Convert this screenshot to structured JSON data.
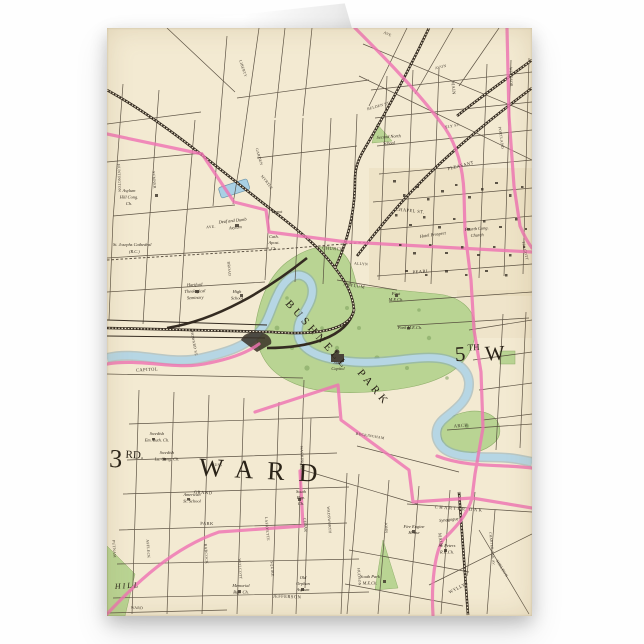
{
  "scene": {
    "background": "#fefefe",
    "paper_color": "#f3ead2",
    "pink_boundary": "#ef74b3",
    "park_green": "#b9d493",
    "river_blue": "#b6d6e4",
    "rail_color": "#342b21",
    "street_color": "#4d4335"
  },
  "map": {
    "big_labels": {
      "ward3_num": "3",
      "ward3_sup": "RD.",
      "ward3_word": "WARD",
      "ward5_num": "5",
      "ward5_sup": "TH",
      "ward5_word": "W",
      "bushnell": "BUSHNELL",
      "bushnell_park": "PARK",
      "hill": "HILL"
    },
    "streets": {
      "pearl": "PEARL",
      "main_top": "MAIN",
      "main_lower": "MAIN",
      "asylum": "ASYLUM",
      "church": "CHURCH",
      "allyn": "ALLYN",
      "chapel": "CHAPEL ST.",
      "pleasant": "PLEASANT",
      "charter_oak": "CHARTER OAK",
      "jefferson": "JEFFERSON",
      "capitol_st": "CAPITOL",
      "howard": "HOWARD ST.",
      "park_st": "PARK",
      "grand": "GRAND",
      "lafayette": "LAFAYETTE",
      "wadsworth": "WADSWORTH",
      "cedar": "CEDAR",
      "hudson": "HUDSON",
      "wyllys": "WYLLYS",
      "arch": "ARCH",
      "belden": "BELDEN ST.",
      "avon": "AVON",
      "portland": "PORTLAND",
      "windsor": "WINDSOR",
      "talcott": "TALCOTT",
      "sumner": "SUMNER",
      "huntington": "HUNTINGTON",
      "broad": "BROAD",
      "washington": "WASHINGTON",
      "liberty": "LIBERTY",
      "ely": "ELY ST.",
      "myrtle": "MYRTLE",
      "garden": "GARDEN",
      "ave_asylum": "AVE.",
      "ave_albany": "AVE",
      "buckingham": "BUCKINGHAM",
      "russ": "RUSS",
      "ward_st": "WARD",
      "putnam": "PUTNAM",
      "affleck": "AFFLECK",
      "wolcott": "WOLCOTT",
      "squire": "SQUIRE",
      "babcock": "BABCOCK",
      "john": "JOHN",
      "sheldon": "SHELDON",
      "charter_oak_av": "CHARTER OAK AV."
    },
    "places": {
      "st_josephs_1": "St. Josephs Cathedral",
      "st_josephs_2": "(R.C.)",
      "seminary_1": "Hartford",
      "seminary_2": "Theological",
      "seminary_3": "Seminary",
      "high_school_1": "High",
      "high_school_2": "School",
      "deaf_dumb_1": "Deaf and Dumb",
      "deaf_dumb_2": "Asylum",
      "asylum_hill_1": "Asylum",
      "asylum_hill_2": "Hill Cong.",
      "asylum_hill_3": "Ch.",
      "second_north_1": "Second North",
      "second_north_2": "School",
      "depot": "Depot",
      "cath_apost_1": "Cath.",
      "cath_apost_2": "Apost.",
      "cath_apost_3": "Ch.",
      "hotel_prospect": "Hotel Prospect",
      "fourth_church_1": "Fourth Cong.",
      "fourth_church_2": "Church",
      "state_capitol_1": "State",
      "state_capitol_2": "Capitol",
      "first_me_1": "First",
      "first_me_2": "M.E.Ch.",
      "park_me": "Park M.E.Ch.",
      "south_bap_1": "South",
      "south_bap_2": "Bap.",
      "south_bap_3": "Ch.",
      "fire_engine_1": "Fire Engine",
      "fire_engine_2": "House",
      "st_peters_1": "St. Peters",
      "st_peters_2": "R.C.Ch.",
      "south_park_1": "South Park",
      "south_park_2": "M.E.Ch.",
      "memorial_1": "Memorial",
      "memorial_2": "Bap. Ch.",
      "orphan_1": "Old",
      "orphan_2": "Orphan",
      "orphan_3": "Asylum",
      "synagogue": "Synagogue",
      "swedish1_1": "Swedish",
      "swedish1_2": "Em. Luth. Ch.",
      "swedish2_1": "Swedish",
      "swedish2_2": "Lu. Cong. Ch.",
      "american_1": "American",
      "american_2": "St. School"
    }
  }
}
